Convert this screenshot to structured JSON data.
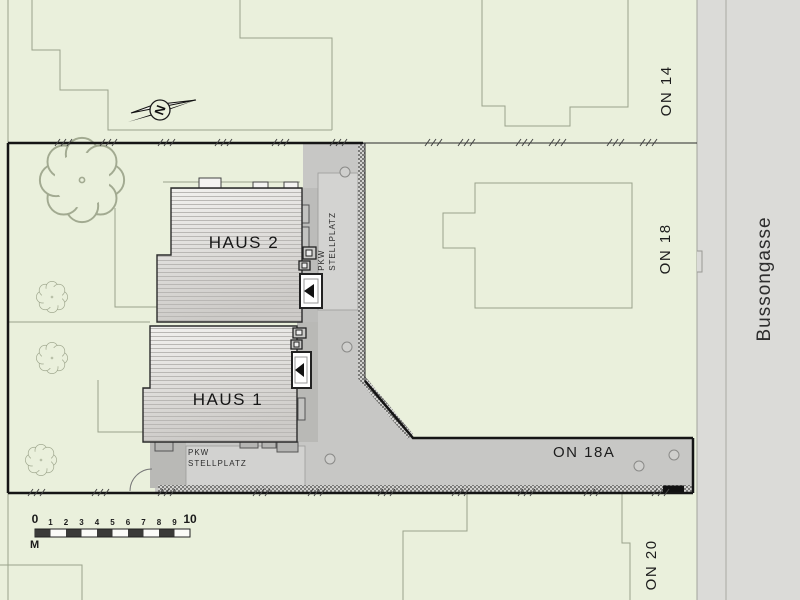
{
  "site_plan": {
    "title": "Site plan with two houses on Bussongasse",
    "buildings": {
      "haus1": "HAUS 1",
      "haus2": "HAUS 2"
    },
    "parcels": {
      "on14": "ON 14",
      "on18": "ON 18",
      "on18a": "ON 18A",
      "on20": "ON 20"
    },
    "street_name": "Bussongasse",
    "parking_label": {
      "line1": "PKW",
      "line2": "STELLPLATZ"
    },
    "north": "N",
    "scale_bar": {
      "ticks": [
        "0",
        "1",
        "2",
        "3",
        "4",
        "5",
        "6",
        "7",
        "8",
        "9",
        "10"
      ],
      "unit": "M"
    },
    "colors": {
      "parcel_green": "#eaf0dc",
      "street_gray": "#dbdbd8",
      "driveway_gray": "#c7c7c5",
      "parking_light_gray": "#d3d3d1",
      "walkway_dark_gray": "#b9b9b6",
      "roof_light": "#f1f0ee",
      "roof_dark": "#cfcdca",
      "boundary_black": "#151515",
      "faint_outline": "#9aa28b"
    }
  }
}
